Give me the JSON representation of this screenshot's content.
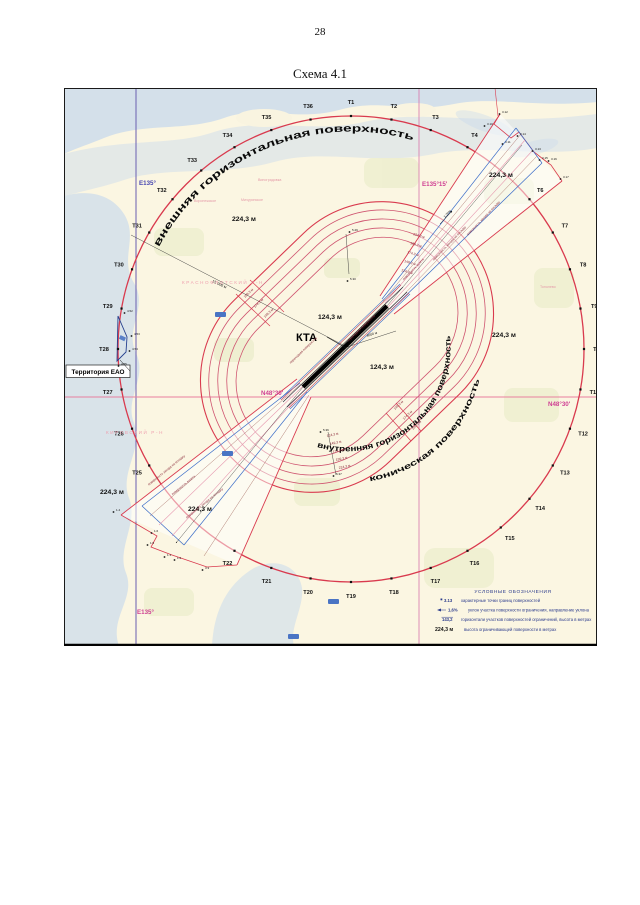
{
  "page": {
    "number": "28",
    "figure_title": "Схема 4.1"
  },
  "map": {
    "coords": {
      "meridian_e135": "E135°",
      "meridian_e135_15": "E135°15'",
      "parallel_n48_30": "N48°30'"
    },
    "kta_label": "КТА",
    "territory_label": "Территория ЕАО",
    "curved": {
      "outer": "внешняя горизонтальная поверхность",
      "inner": "внутренняя горизонтальная поверхность",
      "conical": "коническая поверхность"
    },
    "height_labels": [
      "224,3 м",
      "224,3 м",
      "224,3 м",
      "224,3 м",
      "224,3 м",
      "124,3 м",
      "124,3 м"
    ],
    "ring_scale_top": [
      "224,3 м",
      "199,3 м",
      "174,3 м",
      "149,3 м",
      "124,3 м"
    ],
    "ring_scale_bottom": [
      "124,3 м",
      "149,3 м",
      "174,3 м",
      "199,3 м",
      "224,3 м"
    ],
    "sector_labels_se": [
      "149,3 м",
      "174,3 м",
      "199,3 м"
    ],
    "sector_labels_nw": [
      "199,3 м",
      "174,3 м",
      "149,3 м"
    ],
    "distance_labels": [
      "15 000 м",
      "4000 м"
    ],
    "slope_label": "1,25%",
    "surface_texts": [
      "поверхность взлета",
      "поверхность захода на посадку",
      "переходная поверхность"
    ],
    "t_labels": [
      "T1",
      "T2",
      "T3",
      "T4",
      "T5",
      "T6",
      "T7",
      "T8",
      "T9",
      "T10",
      "T11",
      "T12",
      "T13",
      "T14",
      "T15",
      "T16",
      "T17",
      "T18",
      "T19",
      "T20",
      "T21",
      "T22",
      "T23",
      "T24",
      "T25",
      "T26",
      "T27",
      "T28",
      "T29",
      "T30",
      "T31",
      "T32",
      "T33",
      "T34",
      "T35",
      "T36"
    ],
    "point_labels_ne": [
      "3.10",
      "3.12",
      "3.14",
      "3.11",
      "3.13",
      "3.15",
      "3.16",
      "3.17"
    ],
    "point_labels_sw": [
      "1.4",
      "1.6",
      "1.5",
      "1.1",
      "1.2",
      "3.3"
    ],
    "point_labels_eao": [
      "4.52",
      "4.53",
      "4.54",
      "4.55"
    ],
    "point_labels_rings": [
      "5.29",
      "5.30",
      "5.36",
      "5.37"
    ],
    "place_labels": [
      "Виноградовка",
      "Мичуринское",
      "Воронежское",
      "Тополево"
    ],
    "district_labels": [
      "КРАСНОФЛОТСКИЙ Р-Н",
      "КИРОВСКИЙ Р-Н"
    ]
  },
  "legend": {
    "title": "УСЛОВНЫЕ ОБОЗНАЧЕНИЯ",
    "rows": [
      {
        "key": "3.13",
        "text": "характерные точки границ поверхностей"
      },
      {
        "key": "1,6%",
        "text": "уклон участка поверхности ограничения, направление уклона"
      },
      {
        "key": "143,2",
        "text": "горизонтали участков поверхностей ограничений, высота в метрах"
      },
      {
        "key": "224,3 м",
        "text": "высота ограничивающей поверхности в метрах"
      }
    ]
  },
  "colors": {
    "circle_red": "#d93a4e",
    "ring_pink": "#cf5570",
    "magenta": "#cf3f93",
    "blue_line": "#3a6cc8",
    "navy": "#2a3a8c",
    "maroon": "#8a2838",
    "map_bg": "#fbf6e2",
    "river": "#c3d7ee",
    "field": "#edeecf",
    "place_pink": "#e49aa8"
  }
}
